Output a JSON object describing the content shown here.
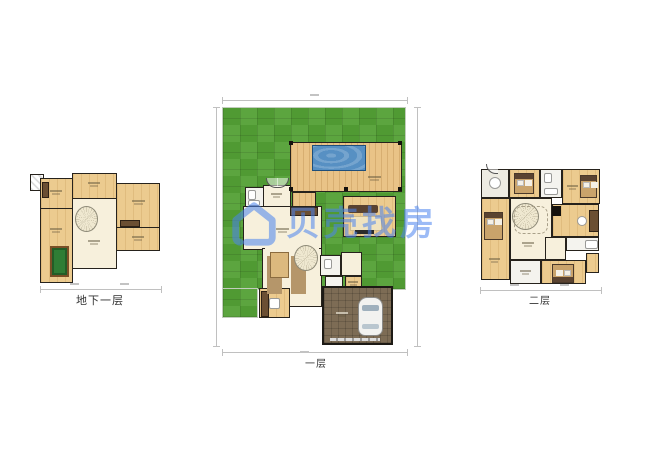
{
  "image": {
    "type": "real-estate-floorplan-set",
    "background": "#ffffff"
  },
  "watermark": {
    "text": "贝壳找房",
    "logo": "beike-house-logo",
    "color": "#4a84ef"
  },
  "plans": {
    "basement": {
      "label": "地下一层"
    },
    "first": {
      "label": "一层"
    },
    "second": {
      "label": "二层"
    }
  },
  "palette": {
    "lawn": "#53a035",
    "deck_wood": "#e9c387",
    "room_wood": "#eccb8f",
    "floor_cream": "#f7f0dc",
    "pool_water": "#5790c3",
    "garage": "#7d6c55",
    "billiard_table": "#2f7d35",
    "wall": "#26221c",
    "dimension_line": "#c0c0c0",
    "label_text": "#333333"
  }
}
